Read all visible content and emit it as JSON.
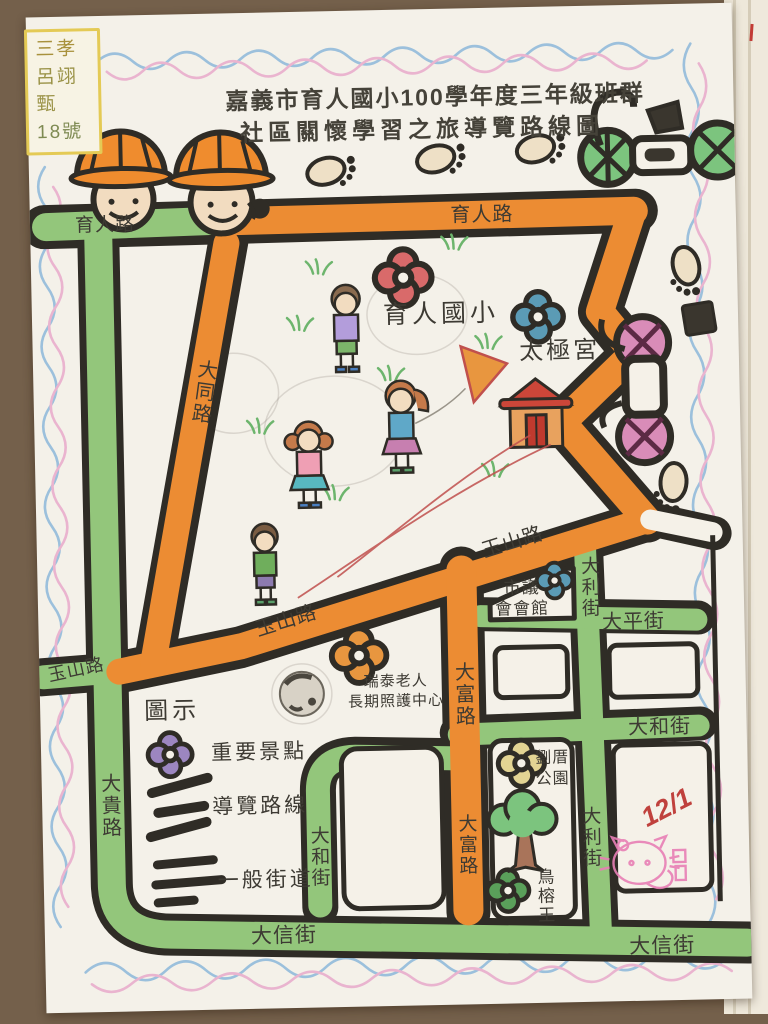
{
  "note": {
    "class_name": "三孝",
    "student_name": "呂翊甄",
    "student_number": "18號"
  },
  "title": {
    "line1": "嘉義市育人國小100學年度三年級班群",
    "line2": "社區關懷學習之旅導覽路線圖"
  },
  "roads": {
    "yuren_left": "育人路",
    "yuren_right": "育人路",
    "datong": "大同路",
    "yushan_upper": "玉山路",
    "yushan_mid": "玉山路",
    "yushan_west": "玉山路",
    "dafu_upper": "大富路",
    "dafu_lower": "大富路",
    "dali_upper": "大利街",
    "dali_lower": "大利街",
    "daping": "大平街",
    "dahe_right": "大和街",
    "dahe_left": "大和街",
    "dagui": "大貴路",
    "daxin_left": "大信街",
    "daxin_right": "大信街"
  },
  "landmarks": {
    "school": "育人國小",
    "temple": "太極宮",
    "council_line1": "市議",
    "council_line2": "會會館",
    "eldercare_line1": "瑞泰老人",
    "eldercare_line2": "長期照護中心",
    "park_line1": "劉厝",
    "park_line2": "公園",
    "banyan_king": "鳥榕王"
  },
  "legend": {
    "title": "圖示",
    "items": [
      {
        "label": "重要景點"
      },
      {
        "label": "導覽路線"
      },
      {
        "label": "一般街道"
      }
    ]
  },
  "annotations": {
    "date": "12/1"
  },
  "colors": {
    "route_orange": "#ec8c33",
    "street_green": "#93c67b",
    "outline_black": "#2f2c26",
    "school_flower": "#d96a6a",
    "temple_flower": "#5b9bb5",
    "eldercare_flower": "#e8963f",
    "park_flower": "#e3d493",
    "banyan_flower": "#5aa05a",
    "legend_flower": "#9c86c0",
    "wave_blue": "#8cb8da",
    "wave_pink": "#e8aacb",
    "stamp_pink": "#e87fb5",
    "pen_red": "#c0504d"
  }
}
